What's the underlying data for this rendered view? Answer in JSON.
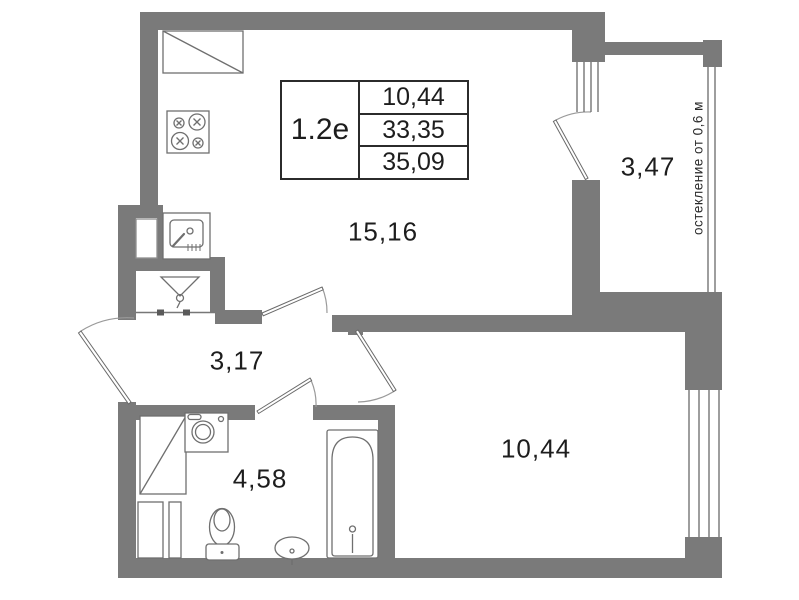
{
  "plan": {
    "info_table": {
      "type_label": "1.2е",
      "rows": [
        "10,44",
        "33,35",
        "35,09"
      ]
    },
    "rooms": {
      "living_kitchen": "15,16",
      "hall": "3,17",
      "bathroom": "4,58",
      "bedroom": "10,44",
      "balcony": "3,47"
    },
    "glazing_note": "остекление от 0,6 м",
    "colors": {
      "wall": "#7a7a7a",
      "line": "#6f6f6f",
      "text": "#1d1d1d",
      "background": "#ffffff"
    }
  }
}
